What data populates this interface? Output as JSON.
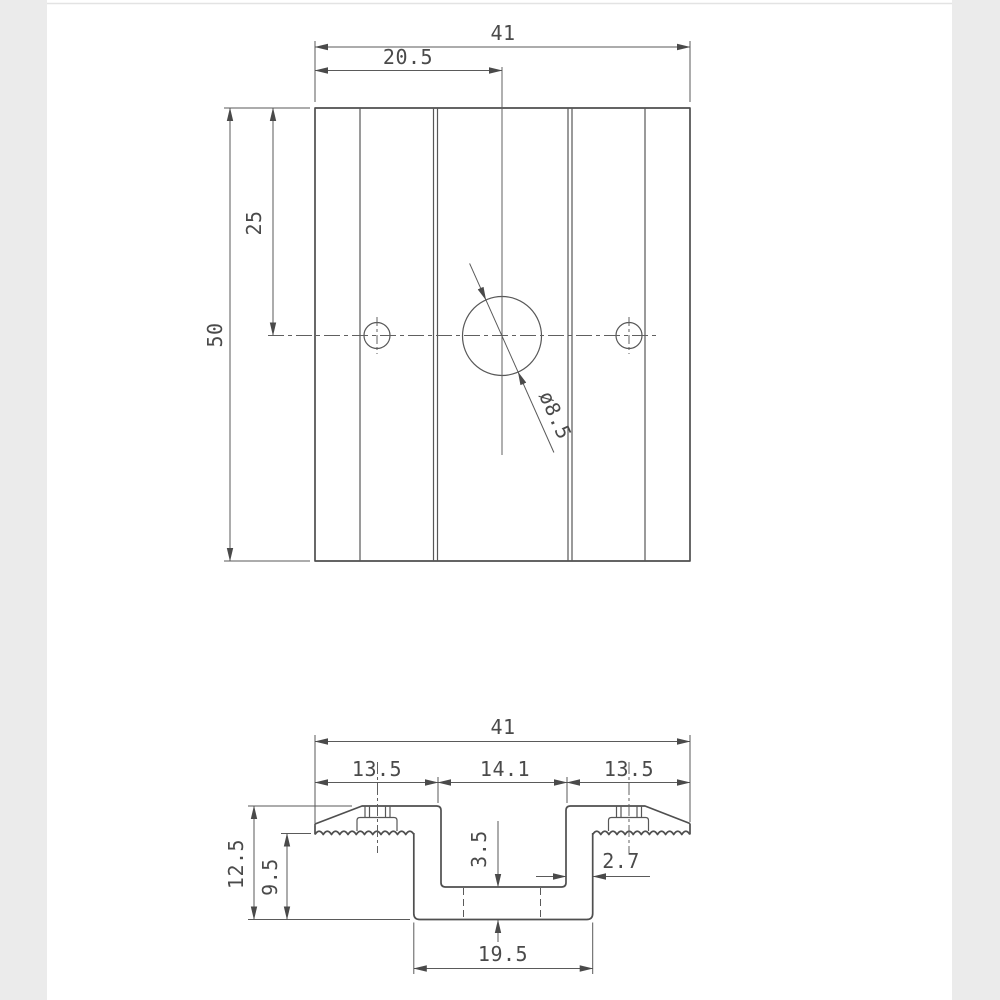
{
  "page": {
    "background": "#ffffff",
    "side_margin_color": "#ebebeb",
    "ink_color": "#4a4a4a",
    "description": "Two-view dimensioned engineering drawing of a solar panel mid-clamp extrusion"
  },
  "views": {
    "plan": {
      "name": "plan-view",
      "dims": {
        "overall_width": "41",
        "hole_offset": "20.5",
        "overall_length": "50",
        "hole_center_offset": "25",
        "hole_diameter": "ø8.5"
      }
    },
    "profile": {
      "name": "section-profile-view",
      "dims": {
        "overall_width": "41",
        "left_flange": "13.5",
        "channel_width": "14.1",
        "right_flange": "13.5",
        "overall_height": "12.5",
        "body_height": "9.5",
        "floor_thickness": "3.5",
        "wall_thickness": "2.7",
        "base_width": "19.5"
      }
    }
  }
}
